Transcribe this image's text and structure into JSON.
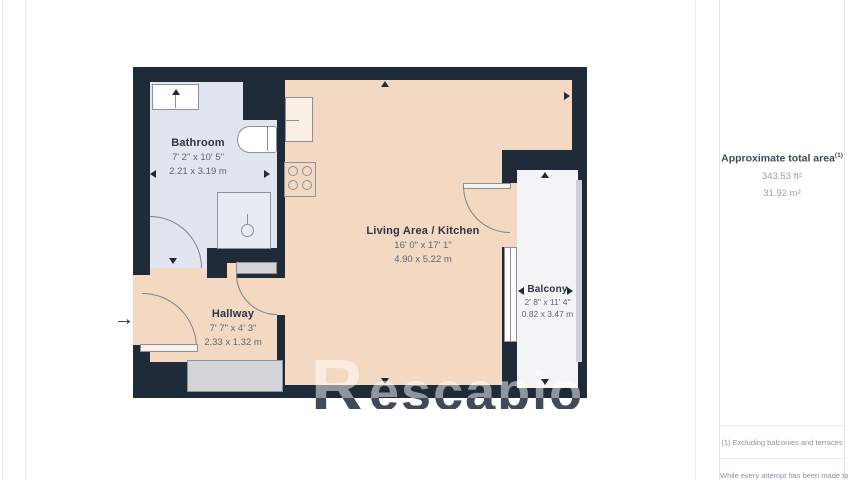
{
  "floorplan": {
    "rooms": {
      "bathroom": {
        "name": "Bathroom",
        "dims_imperial": "7' 2\" x 10' 5\"",
        "dims_metric": "2.21 x 3.19 m"
      },
      "living_kitchen": {
        "name": "Living Area / Kitchen",
        "dims_imperial": "16' 0\" x 17' 1\"",
        "dims_metric": "4.90 x 5.22 m"
      },
      "hallway": {
        "name": "Hallway",
        "dims_imperial": "7' 7\" x 4' 3\"",
        "dims_metric": "2.33 x 1.32 m"
      },
      "balcony": {
        "name": "Balcony",
        "dims_imperial": "2' 8\" x 11' 4\"",
        "dims_metric": "0.82 x 3.47 m"
      }
    },
    "watermark": {
      "initial": "R",
      "rest": "escapio"
    },
    "icons": {
      "entry_arrow": "→"
    },
    "colors": {
      "wall": "#202b39",
      "floor": "#f3d8c2",
      "bathroom_floor": "#e0e5f0",
      "balcony_floor": "#f4f4f6"
    }
  },
  "sidebar": {
    "total_area_label": "Approximate total area",
    "total_area_footnote_marker": "(1)",
    "total_area_sqft": "343.53 ft²",
    "total_area_sqm": "31.92 m²",
    "footnote": "(1) Excluding balconies and terraces",
    "disclaimer_partial": "While every attempt has been made to"
  }
}
